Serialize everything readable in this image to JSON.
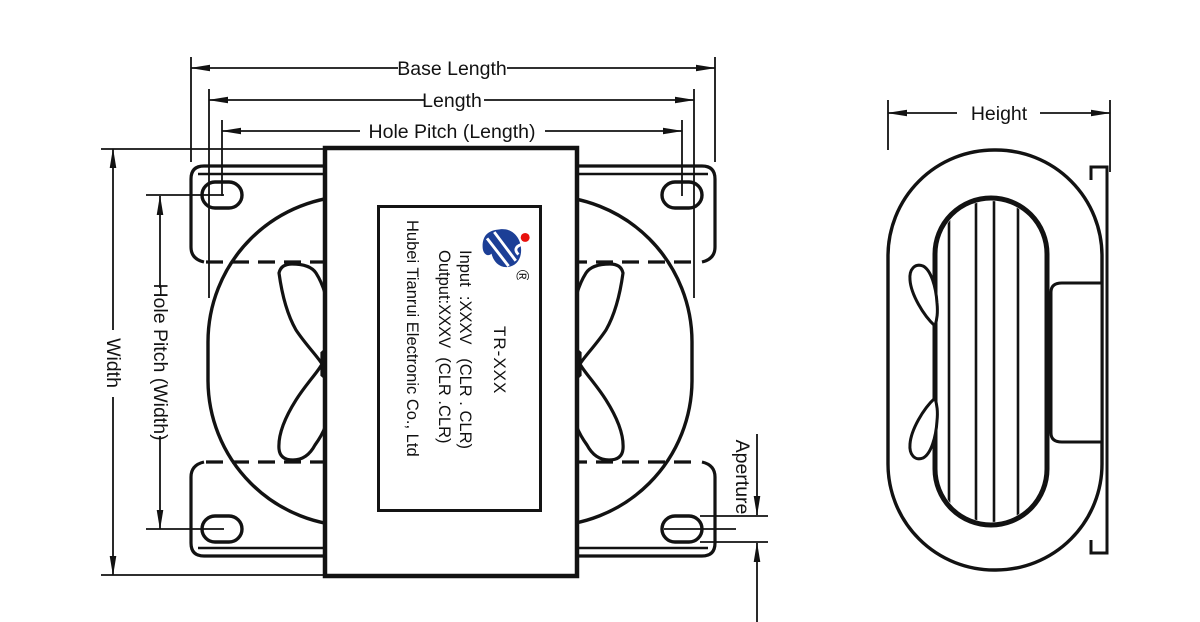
{
  "title": "Transformer outline drawing",
  "views": {
    "front": {
      "dims": {
        "base_length": "Base Length",
        "length": "Length",
        "hole_pitch_length": "Hole Pitch (Length)",
        "width": "Width",
        "hole_pitch_width": "Hole Pitch (Width)",
        "aperture": "Aperture"
      }
    },
    "side": {
      "dims": {
        "height": "Height"
      }
    }
  },
  "label": {
    "model": "TR-XXX",
    "input": "Input  :XXXV   (CLR . CLR)",
    "output": "Output:XXXV  (CLR .CLR)",
    "company": "Hubei Tianrui Electronic Co., Ltd",
    "registered": "®"
  },
  "colors": {
    "line": "#121212",
    "logo_blue": "#1c3f96",
    "logo_red": "#e8110d",
    "background": "#ffffff"
  }
}
